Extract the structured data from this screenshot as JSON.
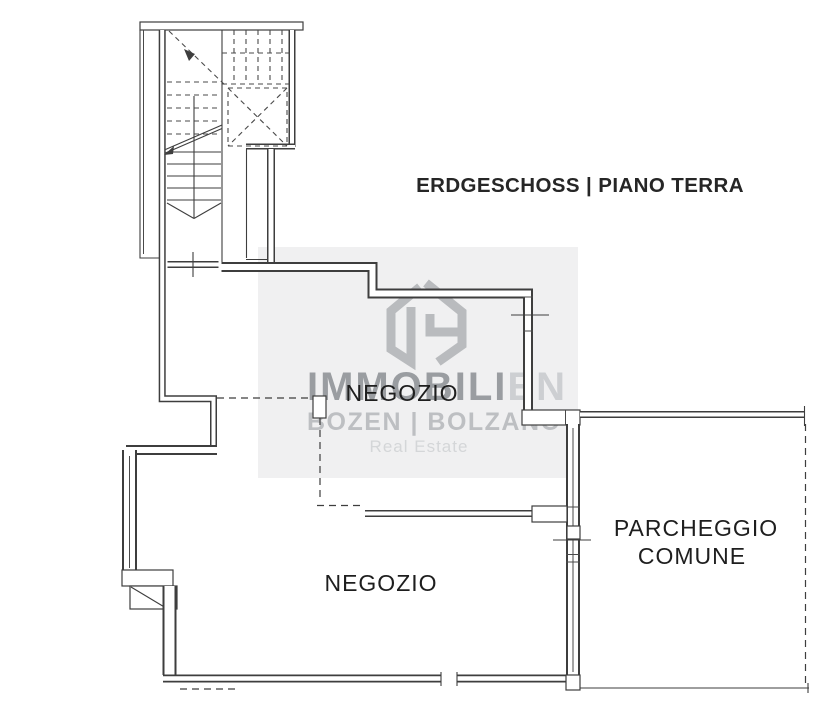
{
  "floor_plan": {
    "title": "ERDGESCHOSS | PIANO TERRA",
    "rooms": [
      {
        "id": "shop-upper",
        "label": "NEGOZIO"
      },
      {
        "id": "shop-lower",
        "label": "NEGOZIO"
      },
      {
        "id": "common-parking",
        "label_line1": "PARCHEGGIO",
        "label_line2": "COMUNE"
      }
    ],
    "features": [
      "staircase",
      "elevator-shaft",
      "dashed-room-boundaries",
      "door-openings",
      "window-ticks"
    ]
  },
  "watermark": {
    "brand_strong": "IMMOBILI",
    "brand_light": "EN",
    "subtitle": "BOZEN | BOLZANO",
    "tagline": "Real Estate"
  },
  "colors": {
    "wall_line": "#3e3e3e",
    "label_text": "#1e1e1e",
    "title_text": "#262626",
    "watermark_panel": "#f0f0f1",
    "watermark_logo": "#b9bbbe",
    "watermark_brand_strong": "#9a9da1",
    "watermark_brand_light": "#cdcfd2",
    "watermark_subtitle": "#bdbfc2",
    "watermark_tagline": "#d4d6d8",
    "background": "#ffffff"
  }
}
